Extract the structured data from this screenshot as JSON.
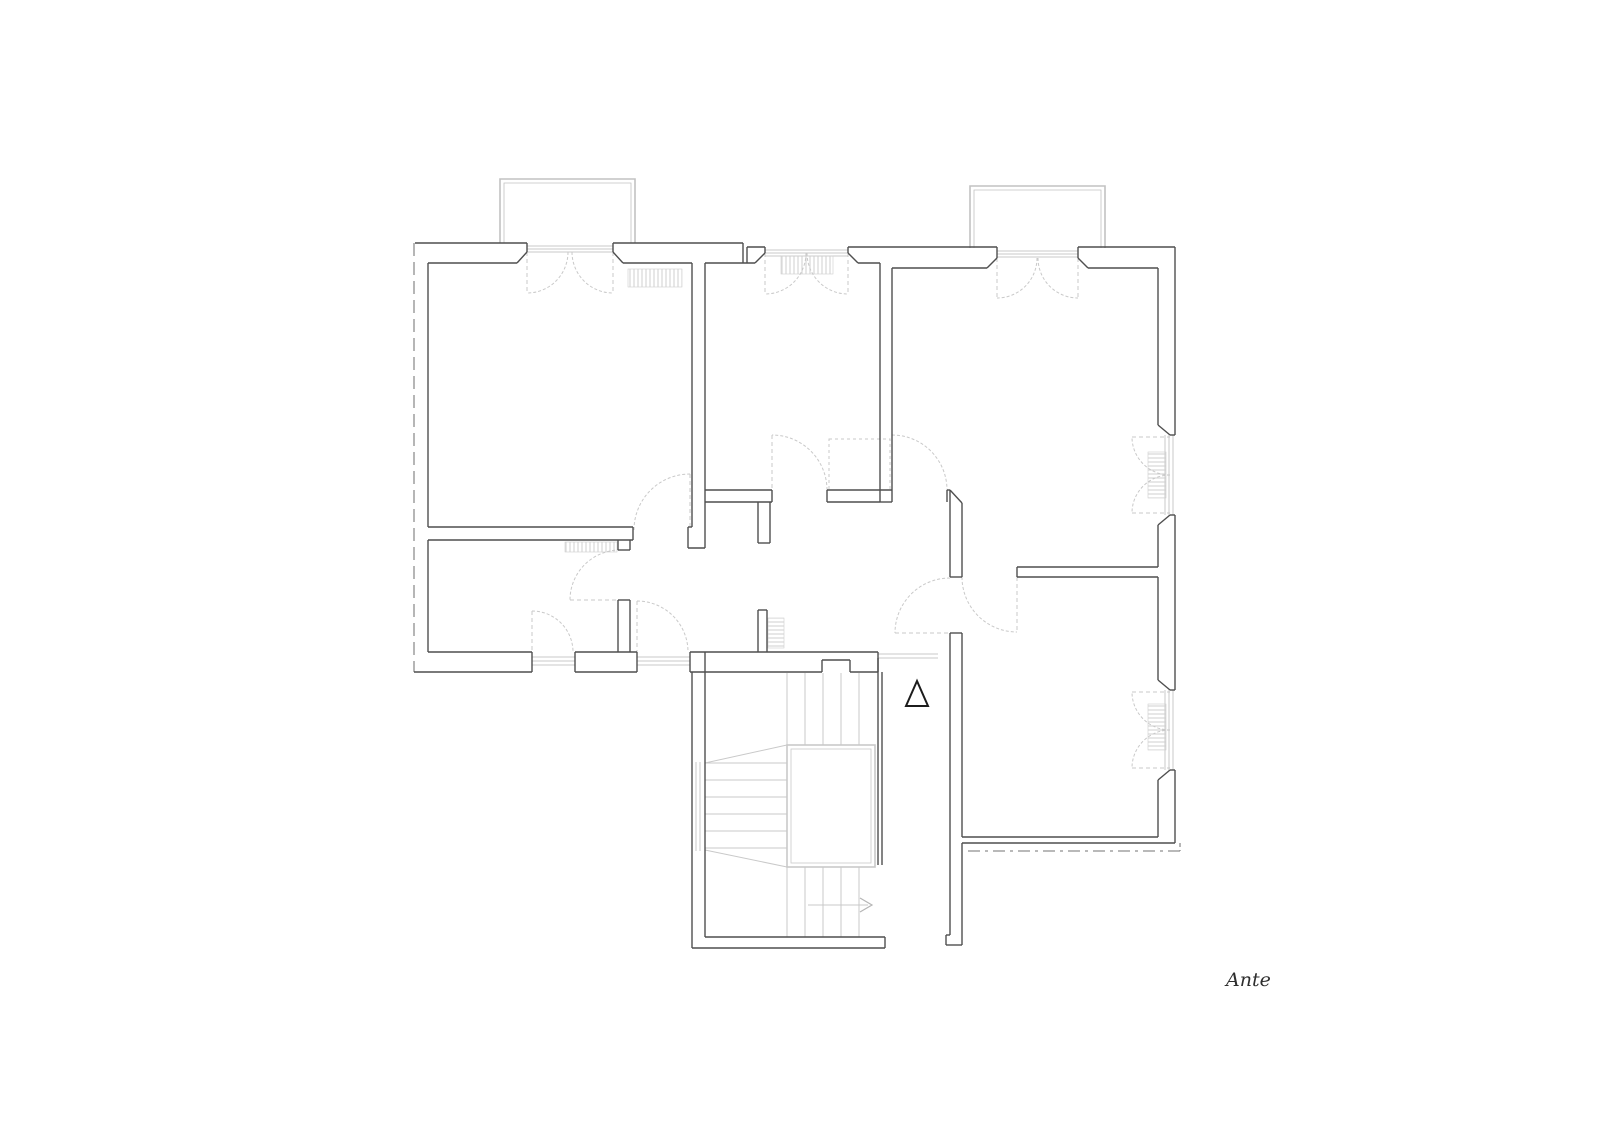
{
  "label": {
    "text": "Ante",
    "x": 1226,
    "y": 986
  },
  "colors": {
    "wall": "#4f4f4f",
    "light": "#c9c9c9",
    "lighter": "#b5b5b5",
    "boundary": "#8f8f8f",
    "balcony": "#c2c2c2",
    "radiator": "#cfcfcf",
    "triangle": "#1c1c1c",
    "text": "#2e2e2e",
    "background": "#ffffff"
  },
  "plan": {
    "walls": [
      [
        415,
        243,
        527,
        243
      ],
      [
        613,
        243,
        743,
        243
      ],
      [
        743,
        243,
        743,
        263
      ],
      [
        747,
        247,
        747,
        263
      ],
      [
        747,
        247,
        765,
        247
      ],
      [
        848,
        247,
        997,
        247
      ],
      [
        1078,
        247,
        1175,
        247
      ],
      [
        1175,
        247,
        1175,
        435
      ],
      [
        1175,
        515,
        1175,
        690
      ],
      [
        1175,
        770,
        1175,
        843
      ],
      [
        428,
        263,
        517,
        263
      ],
      [
        517,
        263,
        527,
        252
      ],
      [
        527,
        243,
        527,
        252
      ],
      [
        613,
        243,
        613,
        252
      ],
      [
        613,
        252,
        623,
        263
      ],
      [
        623,
        263,
        692,
        263
      ],
      [
        692,
        263,
        692,
        527
      ],
      [
        705,
        263,
        705,
        548
      ],
      [
        688,
        527,
        688,
        548
      ],
      [
        688,
        548,
        705,
        548
      ],
      [
        688,
        527,
        692,
        527
      ],
      [
        705,
        263,
        755,
        263
      ],
      [
        755,
        263,
        765,
        253
      ],
      [
        765,
        247,
        765,
        253
      ],
      [
        848,
        247,
        848,
        253
      ],
      [
        848,
        253,
        858,
        263
      ],
      [
        858,
        263,
        880,
        263
      ],
      [
        880,
        263,
        880,
        502
      ],
      [
        892,
        268,
        892,
        490
      ],
      [
        880,
        502,
        892,
        502
      ],
      [
        892,
        490,
        892,
        502
      ],
      [
        892,
        268,
        987,
        268
      ],
      [
        987,
        268,
        997,
        258
      ],
      [
        997,
        247,
        997,
        258
      ],
      [
        1078,
        247,
        1078,
        258
      ],
      [
        1078,
        258,
        1088,
        268
      ],
      [
        1088,
        268,
        1158,
        268
      ],
      [
        1158,
        268,
        1158,
        425
      ],
      [
        1158,
        425,
        1170,
        435
      ],
      [
        1170,
        515,
        1158,
        525
      ],
      [
        1158,
        525,
        1158,
        567
      ],
      [
        1158,
        577,
        1158,
        680
      ],
      [
        1158,
        680,
        1170,
        690
      ],
      [
        1170,
        770,
        1158,
        780
      ],
      [
        1158,
        780,
        1158,
        837
      ],
      [
        1170,
        435,
        1175,
        435
      ],
      [
        1170,
        515,
        1175,
        515
      ],
      [
        1170,
        690,
        1175,
        690
      ],
      [
        1170,
        770,
        1175,
        770
      ],
      [
        428,
        263,
        428,
        527
      ],
      [
        428,
        540,
        428,
        652
      ],
      [
        428,
        527,
        633,
        527
      ],
      [
        428,
        540,
        633,
        540
      ],
      [
        633,
        527,
        633,
        540
      ],
      [
        428,
        652,
        532,
        652
      ],
      [
        575,
        652,
        637,
        652
      ],
      [
        690,
        652,
        878,
        652
      ],
      [
        414,
        672,
        532,
        672
      ],
      [
        575,
        672,
        637,
        672
      ],
      [
        690,
        672,
        822,
        672
      ],
      [
        850,
        672,
        878,
        672
      ],
      [
        822,
        660,
        822,
        672
      ],
      [
        822,
        660,
        850,
        660
      ],
      [
        850,
        660,
        850,
        672
      ],
      [
        878,
        652,
        878,
        672
      ],
      [
        532,
        652,
        532,
        672
      ],
      [
        575,
        652,
        575,
        672
      ],
      [
        637,
        652,
        637,
        672
      ],
      [
        690,
        652,
        690,
        672
      ],
      [
        618,
        540,
        618,
        550
      ],
      [
        618,
        600,
        618,
        652
      ],
      [
        630,
        540,
        630,
        550
      ],
      [
        630,
        600,
        630,
        652
      ],
      [
        618,
        550,
        630,
        550
      ],
      [
        618,
        600,
        630,
        600
      ],
      [
        705,
        490,
        772,
        490
      ],
      [
        705,
        502,
        772,
        502
      ],
      [
        772,
        490,
        772,
        502
      ],
      [
        827,
        490,
        827,
        502
      ],
      [
        827,
        490,
        892,
        490
      ],
      [
        827,
        502,
        880,
        502
      ],
      [
        758,
        502,
        758,
        543
      ],
      [
        770,
        502,
        770,
        543
      ],
      [
        758,
        543,
        770,
        543
      ],
      [
        758,
        610,
        758,
        652
      ],
      [
        767,
        610,
        767,
        652
      ],
      [
        758,
        610,
        767,
        610
      ],
      [
        947,
        490,
        947,
        502
      ],
      [
        947,
        490,
        950,
        490
      ],
      [
        950,
        490,
        962,
        503
      ],
      [
        950,
        490,
        950,
        577
      ],
      [
        962,
        503,
        962,
        567
      ],
      [
        950,
        577,
        962,
        577
      ],
      [
        1017,
        567,
        1158,
        567
      ],
      [
        1017,
        577,
        1158,
        577
      ],
      [
        1017,
        567,
        1017,
        577
      ],
      [
        962,
        567,
        962,
        577
      ],
      [
        950,
        633,
        950,
        935
      ],
      [
        962,
        633,
        962,
        837
      ],
      [
        962,
        843,
        962,
        945
      ],
      [
        950,
        633,
        962,
        633
      ],
      [
        950,
        935,
        946,
        935
      ],
      [
        946,
        935,
        946,
        945
      ],
      [
        946,
        945,
        962,
        945
      ],
      [
        962,
        837,
        1158,
        837
      ],
      [
        962,
        843,
        1158,
        843
      ],
      [
        1158,
        843,
        1175,
        843
      ],
      [
        692,
        672,
        692,
        948
      ],
      [
        705,
        652,
        705,
        937
      ],
      [
        692,
        948,
        885,
        948
      ],
      [
        705,
        937,
        885,
        937
      ],
      [
        885,
        937,
        885,
        948
      ],
      [
        878,
        658,
        878,
        865
      ],
      [
        882,
        672,
        882,
        865
      ]
    ],
    "light_lines": [
      [
        527,
        246,
        613,
        246
      ],
      [
        527,
        249,
        613,
        249
      ],
      [
        527,
        252,
        613,
        252
      ],
      [
        765,
        250,
        848,
        250
      ],
      [
        765,
        253,
        848,
        253
      ],
      [
        765,
        256,
        848,
        256
      ],
      [
        997,
        251,
        1078,
        251
      ],
      [
        997,
        254,
        1078,
        254
      ],
      [
        997,
        257,
        1078,
        257
      ],
      [
        532,
        657,
        575,
        657
      ],
      [
        532,
        661,
        575,
        661
      ],
      [
        532,
        665,
        575,
        665
      ],
      [
        637,
        657,
        690,
        657
      ],
      [
        637,
        661,
        690,
        661
      ],
      [
        637,
        665,
        690,
        665
      ],
      [
        1165,
        435,
        1165,
        515
      ],
      [
        1169,
        435,
        1169,
        515
      ],
      [
        1173,
        435,
        1173,
        515
      ],
      [
        1165,
        690,
        1165,
        770
      ],
      [
        1169,
        690,
        1169,
        770
      ],
      [
        1173,
        690,
        1173,
        770
      ],
      [
        878,
        654,
        938,
        654
      ],
      [
        878,
        658,
        938,
        658
      ],
      [
        696,
        762,
        696,
        851
      ],
      [
        700,
        762,
        700,
        851
      ],
      [
        787,
        673,
        787,
        745
      ],
      [
        805,
        673,
        805,
        745
      ],
      [
        823,
        673,
        823,
        745
      ],
      [
        841,
        673,
        841,
        745
      ],
      [
        859,
        673,
        859,
        745
      ],
      [
        787,
        867,
        787,
        937
      ],
      [
        805,
        867,
        805,
        937
      ],
      [
        823,
        867,
        823,
        937
      ],
      [
        841,
        867,
        841,
        937
      ],
      [
        859,
        867,
        859,
        937
      ],
      [
        705,
        763,
        787,
        763
      ],
      [
        705,
        780,
        787,
        780
      ],
      [
        705,
        797,
        787,
        797
      ],
      [
        705,
        814,
        787,
        814
      ],
      [
        705,
        831,
        787,
        831
      ],
      [
        705,
        848,
        787,
        848
      ],
      [
        705,
        763,
        787,
        745
      ],
      [
        705,
        850,
        787,
        867
      ],
      [
        808,
        905,
        868,
        905
      ]
    ],
    "leaves": [
      [
        527,
        252,
        527,
        293
      ],
      [
        613,
        252,
        613,
        293
      ],
      [
        765,
        253,
        765,
        294
      ],
      [
        848,
        253,
        848,
        294
      ],
      [
        997,
        258,
        997,
        298
      ],
      [
        1078,
        258,
        1078,
        298
      ],
      [
        532,
        611,
        532,
        652
      ],
      [
        637,
        601,
        637,
        652
      ],
      [
        1132,
        437,
        1170,
        437
      ],
      [
        1132,
        513,
        1170,
        513
      ],
      [
        1132,
        692,
        1170,
        692
      ],
      [
        1132,
        768,
        1170,
        768
      ],
      [
        690,
        474,
        690,
        530
      ],
      [
        772,
        435,
        772,
        490
      ],
      [
        892,
        435,
        892,
        490
      ],
      [
        570,
        600,
        620,
        600
      ],
      [
        895,
        633,
        950,
        633
      ],
      [
        1017,
        577,
        1017,
        632
      ]
    ],
    "arcs": [
      {
        "sx": 568,
        "sy": 252,
        "r": 41,
        "sweep": 1,
        "ex": 527,
        "ey": 293
      },
      {
        "sx": 572,
        "sy": 252,
        "r": 41,
        "sweep": 0,
        "ex": 613,
        "ey": 293
      },
      {
        "sx": 806,
        "sy": 253,
        "r": 41,
        "sweep": 1,
        "ex": 765,
        "ey": 294
      },
      {
        "sx": 807,
        "sy": 253,
        "r": 41,
        "sweep": 0,
        "ex": 848,
        "ey": 294
      },
      {
        "sx": 1037,
        "sy": 258,
        "r": 40,
        "sweep": 1,
        "ex": 997,
        "ey": 298
      },
      {
        "sx": 1038,
        "sy": 258,
        "r": 40,
        "sweep": 0,
        "ex": 1078,
        "ey": 298
      },
      {
        "sx": 532,
        "sy": 611,
        "r": 41,
        "sweep": 1,
        "ex": 573,
        "ey": 652
      },
      {
        "sx": 637,
        "sy": 601,
        "r": 51,
        "sweep": 1,
        "ex": 688,
        "ey": 652
      },
      {
        "sx": 1170,
        "sy": 475,
        "r": 38,
        "sweep": 1,
        "ex": 1132,
        "ey": 437
      },
      {
        "sx": 1170,
        "sy": 475,
        "r": 38,
        "sweep": 0,
        "ex": 1132,
        "ey": 513
      },
      {
        "sx": 1170,
        "sy": 730,
        "r": 38,
        "sweep": 1,
        "ex": 1132,
        "ey": 692
      },
      {
        "sx": 1170,
        "sy": 730,
        "r": 38,
        "sweep": 0,
        "ex": 1132,
        "ey": 768
      },
      {
        "sx": 634,
        "sy": 530,
        "r": 56,
        "sweep": 1,
        "ex": 690,
        "ey": 474
      },
      {
        "sx": 827,
        "sy": 490,
        "r": 55,
        "sweep": 0,
        "ex": 772,
        "ey": 435
      },
      {
        "sx": 892,
        "sy": 435,
        "r": 55,
        "sweep": 1,
        "ex": 947,
        "ey": 490
      },
      {
        "sx": 620,
        "sy": 550,
        "r": 50,
        "sweep": 0,
        "ex": 570,
        "ey": 600
      },
      {
        "sx": 950,
        "sy": 578,
        "r": 55,
        "sweep": 0,
        "ex": 895,
        "ey": 633
      },
      {
        "sx": 962,
        "sy": 577,
        "r": 55,
        "sweep": 0,
        "ex": 1017,
        "ey": 632
      }
    ],
    "boundary_lines": [
      {
        "seg": [
          414,
          243,
          414,
          672
        ],
        "dash": "13,6"
      },
      {
        "seg": [
          968,
          851,
          1180,
          851
        ],
        "dash": "12,5,3,5"
      },
      {
        "seg": [
          1180,
          843,
          1180,
          851
        ],
        "dash": "4,3"
      }
    ],
    "balconies": [
      {
        "x": 500,
        "y": 179,
        "w": 135,
        "h": 64,
        "inset": 4
      },
      {
        "x": 970,
        "y": 186,
        "w": 135,
        "h": 62,
        "inset": 4
      }
    ],
    "radiators": [
      {
        "x": 628,
        "y": 269,
        "w": 54,
        "h": 18,
        "o": "h"
      },
      {
        "x": 565,
        "y": 542,
        "w": 52,
        "h": 10,
        "o": "h"
      },
      {
        "x": 781,
        "y": 256,
        "w": 52,
        "h": 18,
        "o": "h"
      },
      {
        "x": 768,
        "y": 618,
        "w": 16,
        "h": 30,
        "o": "v"
      },
      {
        "x": 1148,
        "y": 452,
        "w": 18,
        "h": 46,
        "o": "v"
      },
      {
        "x": 1148,
        "y": 704,
        "w": 18,
        "h": 46,
        "o": "v"
      }
    ],
    "closet": {
      "x": 829,
      "y": 439,
      "w": 61,
      "h": 51
    },
    "stair_well": {
      "outer": [
        787,
        745,
        88,
        122
      ],
      "inner": [
        791,
        749,
        80,
        114
      ]
    },
    "triangle_points": "917,681 906,706 928,706",
    "arrowhead_points": "860,898 872,905 860,912"
  }
}
